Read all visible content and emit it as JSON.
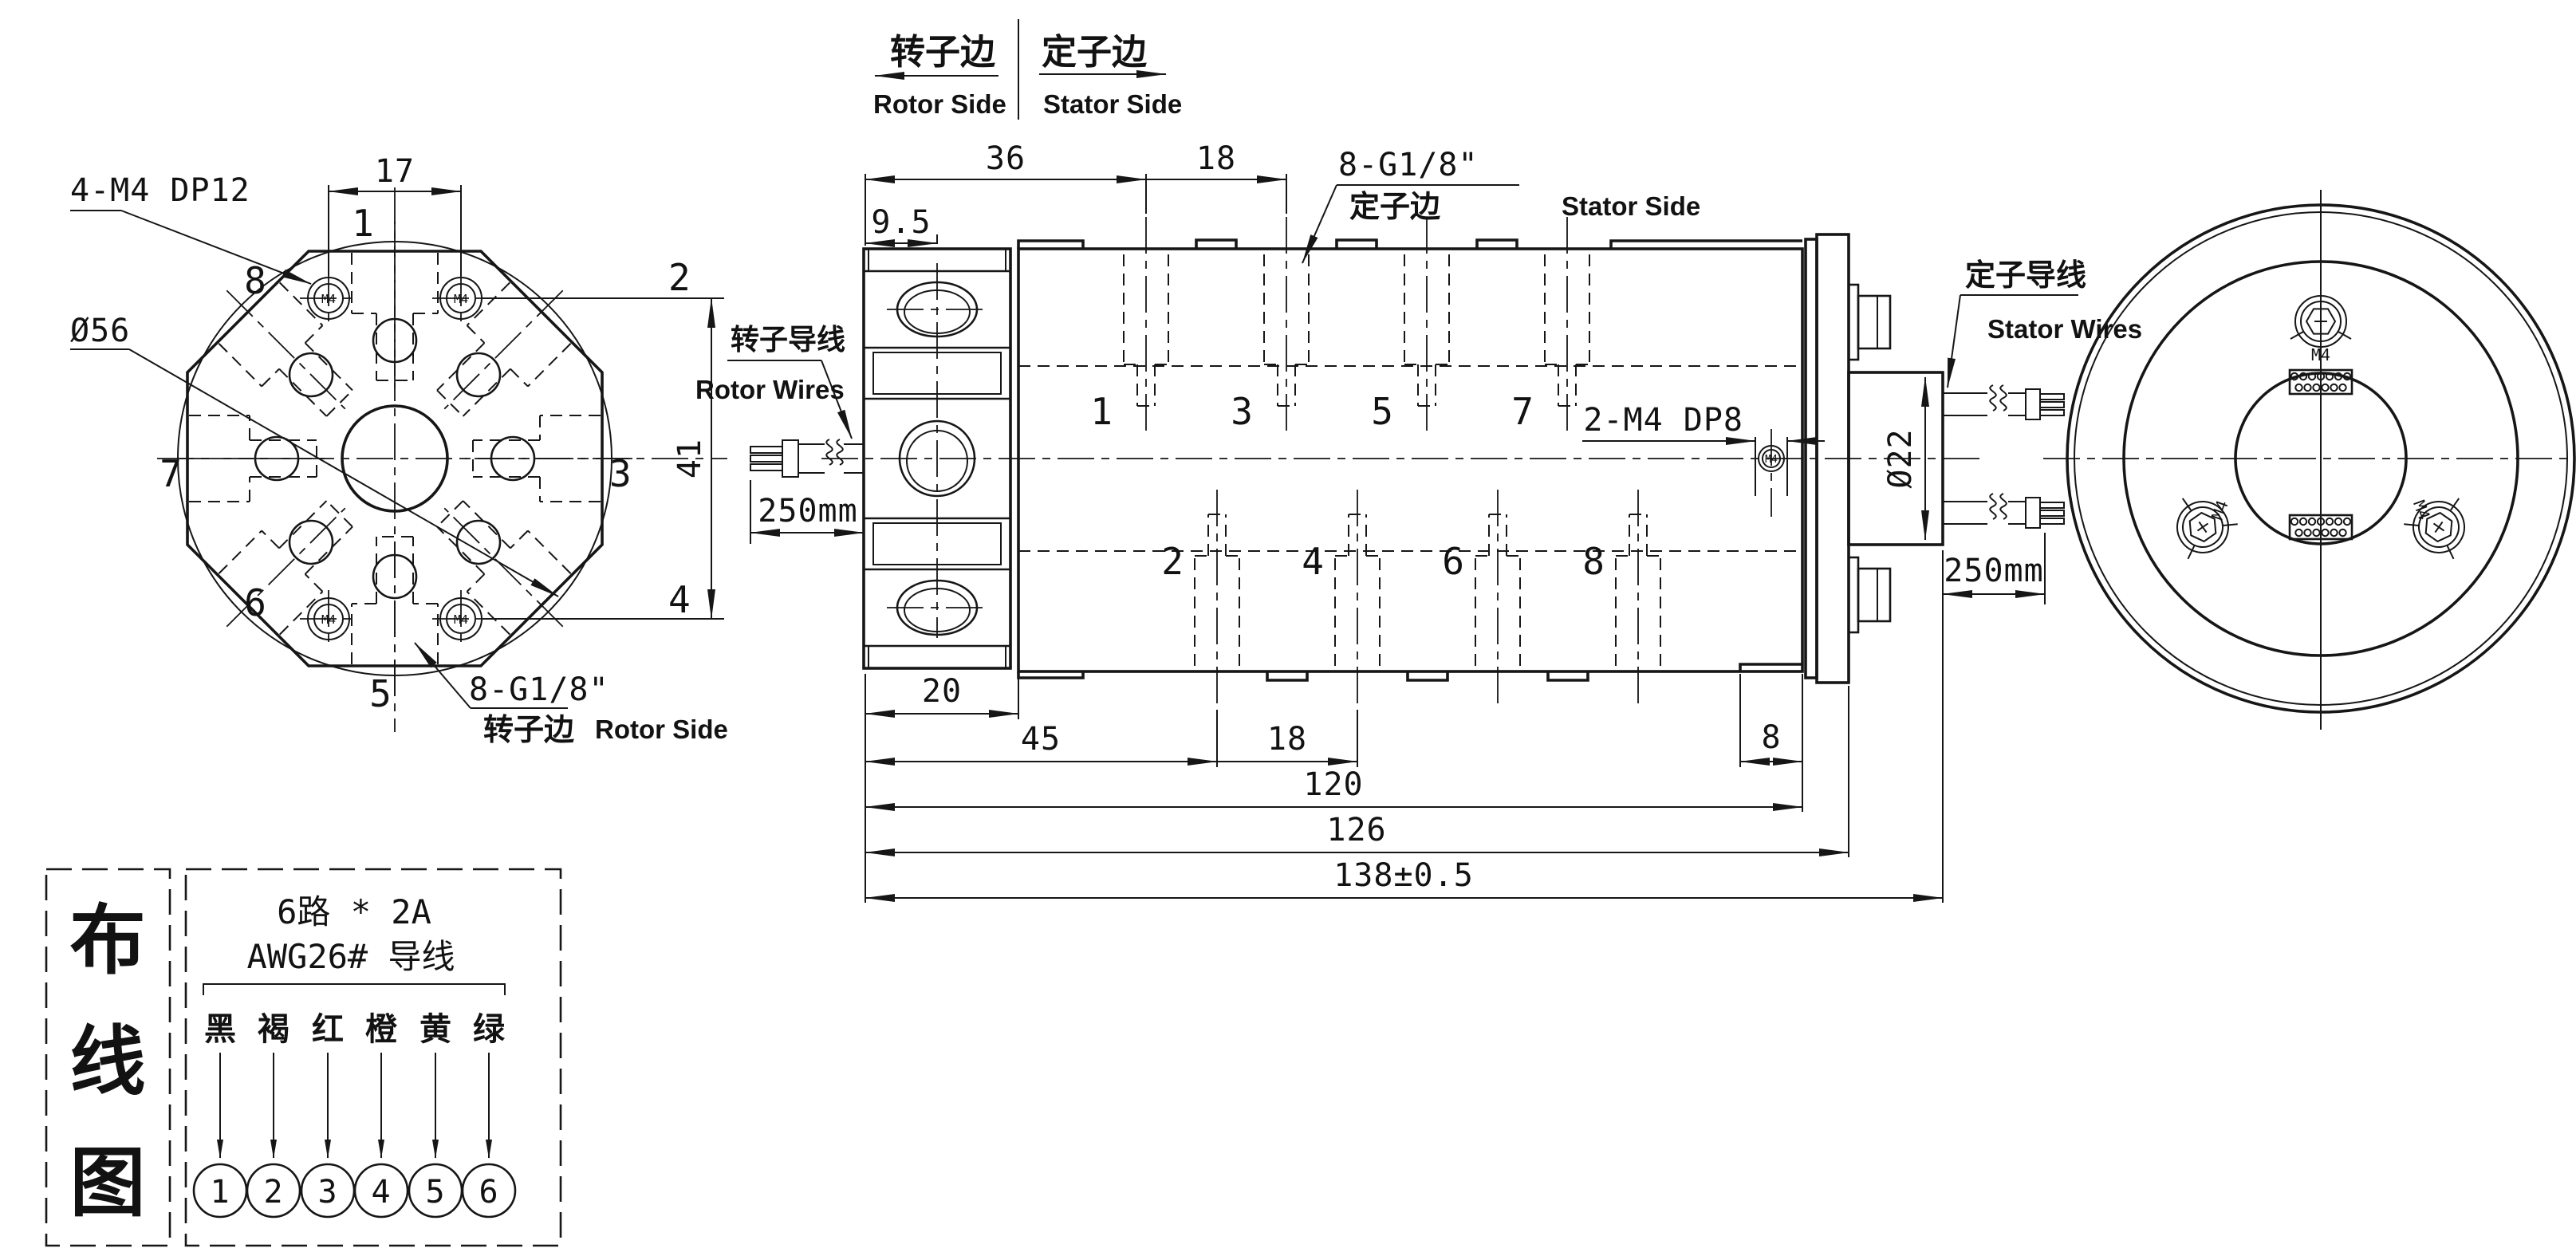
{
  "header": {
    "rotor_cn": "转子边",
    "rotor_en": "Rotor Side",
    "stator_cn": "定子边",
    "stator_en": "Stator Side"
  },
  "front_view": {
    "dim_17": "17",
    "dim_41": "41",
    "dia_56": "Ø56",
    "screw_note": "4-M4 DP12",
    "g18": "8-G1/8\"",
    "g18_cn": "转子边",
    "g18_en": "Rotor Side",
    "screw": "M4",
    "ports": [
      "1",
      "2",
      "3",
      "4",
      "5",
      "6",
      "7",
      "8"
    ]
  },
  "side_view": {
    "dim_36": "36",
    "dim_18_top": "18",
    "dim_95": "9.5",
    "dim_20": "20",
    "dim_45": "45",
    "dim_18_bottom": "18",
    "dim_8": "8",
    "dim_120": "120",
    "dim_126": "126",
    "dim_138": "138±0.5",
    "dia_22": "Ø22",
    "screw_note": "2-M4 DP8",
    "screw": "M4",
    "g18": "8-G1/8\"",
    "g18_cn": "定子边",
    "g18_en": "Stator Side",
    "rotor_wires_cn": "转子导线",
    "rotor_wires_en": "Rotor Wires",
    "rotor_wire_len": "250mm",
    "stator_wires_cn": "定子导线",
    "stator_wires_en": "Stator Wires",
    "stator_wire_len": "250mm",
    "top_ports": [
      "1",
      "3",
      "5",
      "7"
    ],
    "bottom_ports": [
      "2",
      "4",
      "6",
      "8"
    ]
  },
  "rear_view": {
    "screw": "M4"
  },
  "wiring": {
    "title": [
      "布",
      "线",
      "图"
    ],
    "spec_line1": "6路 * 2A",
    "spec_line2": "AWG26# 导线",
    "colors": [
      "黑",
      "褐",
      "红",
      "橙",
      "黄",
      "绿"
    ],
    "terminals": [
      "1",
      "2",
      "3",
      "4",
      "5",
      "6"
    ]
  }
}
